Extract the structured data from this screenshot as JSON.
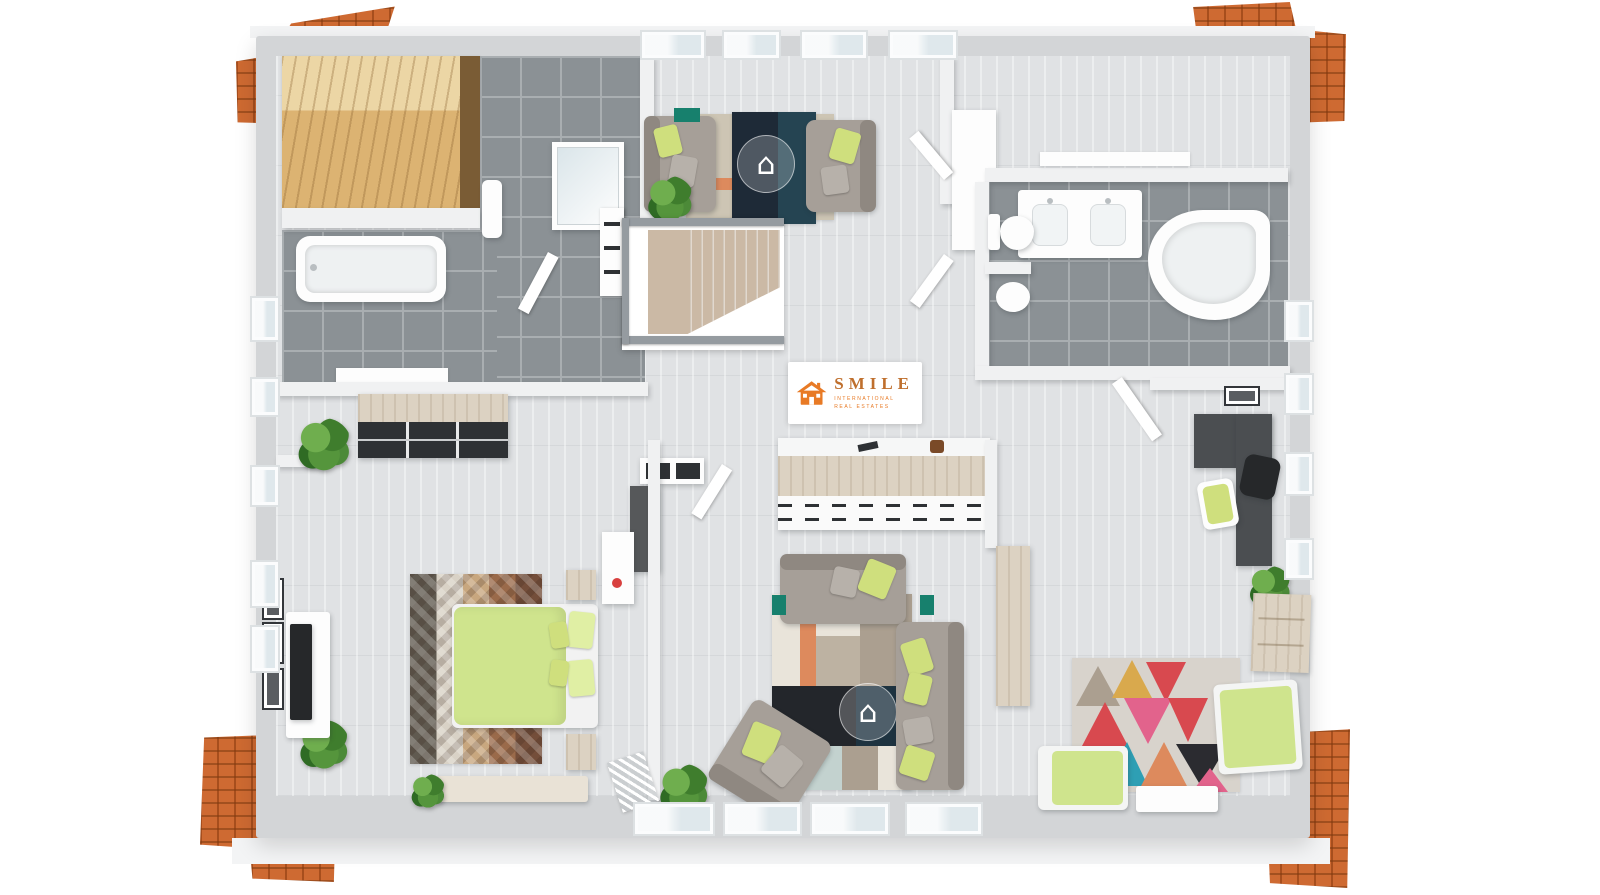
{
  "watermark": {
    "brand": "SMILE",
    "subtitle_line1": "INTERNATIONAL",
    "subtitle_line2": "REAL ESTATES",
    "house_glyph": "⌂"
  },
  "colors": {
    "roof": "#c85f28",
    "roof_dark": "#7e3a10",
    "roof_light": "#e08a4e",
    "wall_top": "#d3d5d7",
    "wall_face": "#f0f1f2",
    "floor_wood": "#e0e2e4",
    "tile": "#8b9195",
    "grout": "#a9aeb1",
    "sauna_wood": "#dcb372",
    "white_fix": "#fdfdfd",
    "sofa": "#a69f98",
    "sofa_dark": "#8f8881",
    "pillow": "#cfdf7d",
    "pillow_light": "#e0efa4",
    "rug_navy": "#1e2a37",
    "rug_teal_block": "#254452",
    "rug_beige": "#cdc5b4",
    "rug_orange": "#dd8a5d",
    "stair": "#cbb9a5",
    "rail": "#959ba0",
    "desk": "#4b4e51",
    "teal": "#17806d",
    "wood_light": "#dcd2c2",
    "dark_furn": "#2e3134",
    "bed_green": "#cfe48d",
    "plant": "#4c8a38",
    "brand": "#e87a25",
    "brand_text": "#bf6f2d",
    "rug_red": "#d8494f",
    "rug_pink": "#e2638c",
    "rug_teal2": "#2e9fb4",
    "rug_black": "#2b2b30",
    "rug_olive": "#9aa04e",
    "rug_must": "#d9a94d",
    "chev1": "#605a50",
    "chev2": "#d9d2c6",
    "chev3": "#c8a77f",
    "chev4": "#9a6a4a",
    "chev5": "#744e3a",
    "black_tv": "#26282a",
    "glass": "#dfe8ec",
    "rug_cream": "#e9e4da",
    "rug_taupe": "#ab9f90",
    "rug_blue": "#c3d2cf",
    "rug_blk2": "#23262b",
    "rug_nvy2": "#1e3340"
  }
}
